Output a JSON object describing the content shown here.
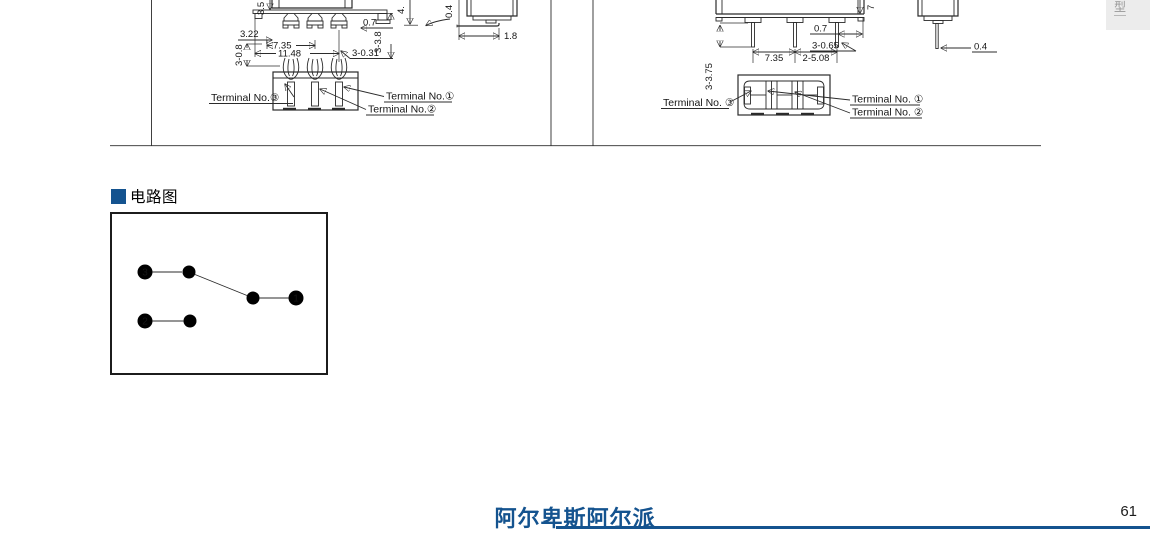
{
  "header": {
    "side_tab": "型"
  },
  "section": {
    "title": "电路图"
  },
  "colors": {
    "accent_blue": "#14538f",
    "tab_gray": "#ececec"
  },
  "drawings": {
    "left": {
      "front": {
        "d35": "3.5",
        "d07": "0.7",
        "d322": "3.22",
        "d735": "7.35",
        "d1148": "11.48",
        "d3031": "3-0.31",
        "d338": "3-3.8",
        "d308": "3-0.8"
      },
      "side": {
        "d4": "4.",
        "d04": "0.4",
        "d18": "1.8"
      },
      "bottom": {
        "t3": "Terminal No.③",
        "t1": "Terminal No.①",
        "t2": "Terminal No.②"
      }
    },
    "right": {
      "front": {
        "d7": "7",
        "d07": "0.7",
        "d3065": "3-0.65",
        "d735": "7.35",
        "d2508": "2-5.08",
        "d3375": "3-3.75"
      },
      "side": {
        "d04": "0.4"
      },
      "bottom": {
        "t3": "Terminal No. ③",
        "t1": "Terminal No. ①",
        "t2": "Terminal No. ②"
      }
    }
  },
  "circuit": {
    "n1": "1",
    "n2": "2",
    "n3": "3"
  },
  "footer": {
    "brand": "阿尔卑斯阿尔派",
    "page": "61"
  }
}
